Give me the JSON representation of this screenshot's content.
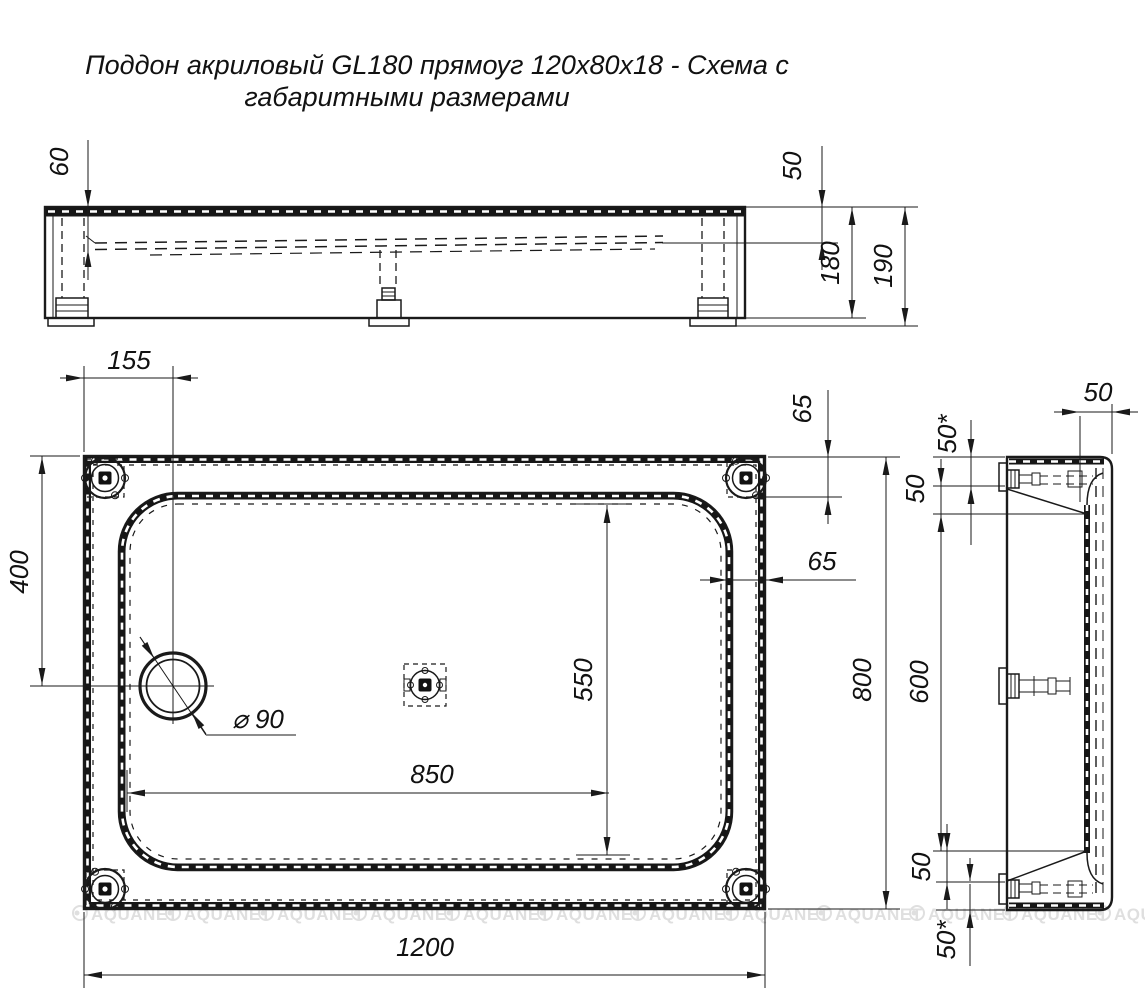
{
  "title": {
    "line1": "Поддон акриловый  GL180 прямоуг 120x80x18 - Схема с",
    "line2": "габаритными размерами"
  },
  "views": {
    "front": {
      "label": "front-elevation",
      "dims": {
        "inner_depth_left": "60",
        "inner_depth_right": "50",
        "body_height": "180",
        "total_height": "190"
      }
    },
    "plan": {
      "label": "plan-view",
      "dims": {
        "drain_offset_x": "155",
        "drain_offset_y": "400",
        "drain_diameter": "⌀ 90",
        "rim_top": "65",
        "rim_right": "65",
        "floor_length": "850",
        "floor_width": "550",
        "overall_length": "1200",
        "overall_width": "800"
      }
    },
    "side": {
      "label": "side-section",
      "dims": {
        "rim_width": "50",
        "offset_top_star": "50*",
        "offset_top": "50",
        "leg_spacing": "600",
        "offset_bottom": "50",
        "offset_bottom_star": "50*"
      }
    }
  },
  "watermark": {
    "text": "AQUANET"
  },
  "colors": {
    "line": "#1a1a1a",
    "watermark": "#c5c5c5",
    "background": "#ffffff"
  }
}
